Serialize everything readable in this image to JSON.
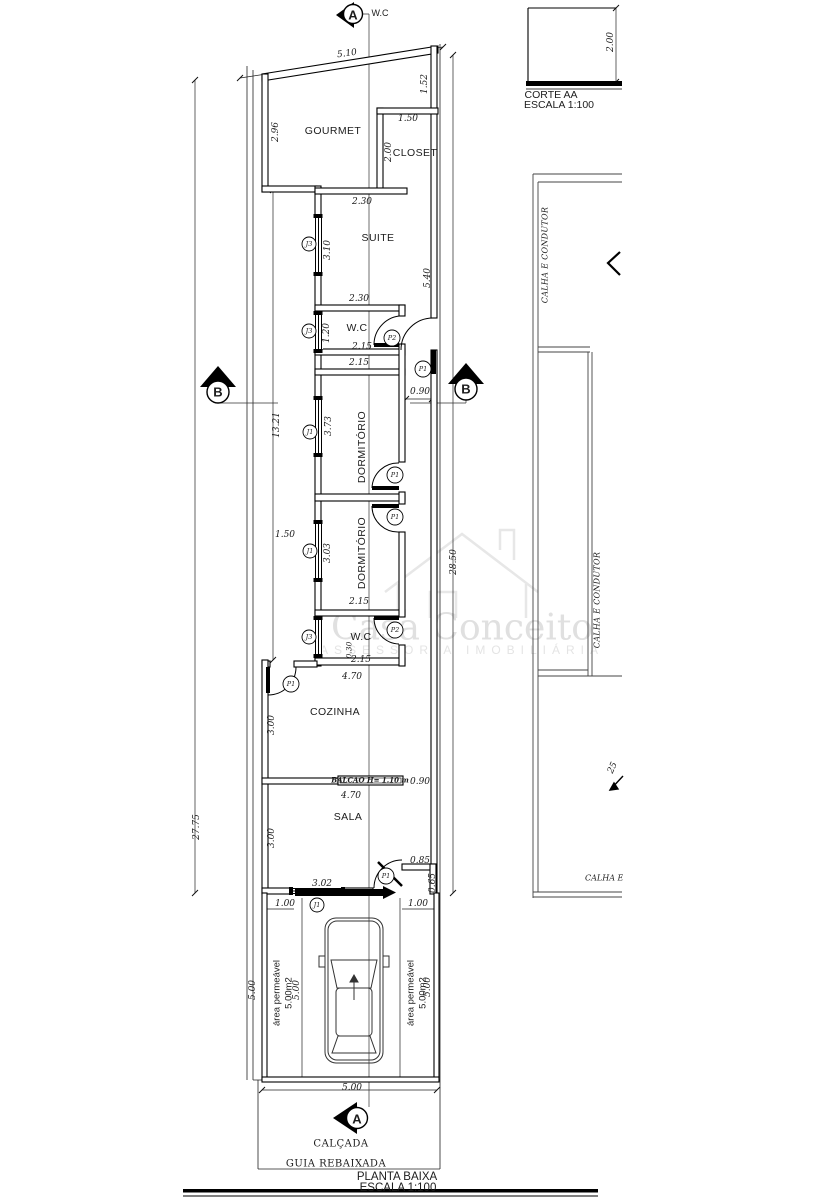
{
  "drawing": {
    "type": "architectural floor plan",
    "line_color": "#000000",
    "background": "#ffffff",
    "watermark_color": "#e0e0e0"
  },
  "watermark": {
    "brand": "Casa Conceito",
    "subtitle": "ASSESSORIA IMOBILIÁRIA"
  },
  "labels": [
    {
      "n": "room-label-gourmet",
      "t": "GOURMET",
      "x": 333,
      "y": 131,
      "c": "room"
    },
    {
      "n": "room-label-closet",
      "t": "CLOSET",
      "x": 415,
      "y": 153,
      "c": "room"
    },
    {
      "n": "room-label-suite",
      "t": "SUITE",
      "x": 378,
      "y": 238,
      "c": "room"
    },
    {
      "n": "room-label-wc-suite",
      "t": "W.C",
      "x": 357,
      "y": 328,
      "c": "room"
    },
    {
      "n": "room-label-dormitorio-1",
      "t": "DORMITÓRIO",
      "x": 362,
      "y": 447,
      "r": -90,
      "c": "room"
    },
    {
      "n": "room-label-dormitorio-2",
      "t": "DORMITÓRIO",
      "x": 362,
      "y": 553,
      "r": -90,
      "c": "room"
    },
    {
      "n": "room-label-wc-2",
      "t": "W.C",
      "x": 361,
      "y": 637,
      "c": "room"
    },
    {
      "n": "room-label-cozinha",
      "t": "COZINHA",
      "x": 335,
      "y": 712,
      "c": "room"
    },
    {
      "n": "room-label-sala",
      "t": "SALA",
      "x": 348,
      "y": 817,
      "c": "room"
    },
    {
      "n": "section-a-top-text",
      "t": "W.C",
      "x": 380,
      "y": 13,
      "c": "room9"
    },
    {
      "n": "area-permeavel-left-line1",
      "t": "área permeável",
      "x": 277,
      "y": 993,
      "r": -90,
      "c": "room10"
    },
    {
      "n": "area-permeavel-left-line2",
      "t": "5.00m2",
      "x": 289,
      "y": 993,
      "r": -90,
      "c": "room10"
    },
    {
      "n": "area-permeavel-right-line1",
      "t": "área permeável",
      "x": 411,
      "y": 993,
      "r": -90,
      "c": "room10"
    },
    {
      "n": "area-permeavel-right-line2",
      "t": "5.00m2",
      "x": 423,
      "y": 993,
      "r": -90,
      "c": "room10"
    },
    {
      "n": "dim-top-width",
      "t": "5.10",
      "x": 347,
      "y": 54,
      "r": -8,
      "c": "dim"
    },
    {
      "n": "dim-gourmet-left",
      "t": "2.96",
      "x": 276,
      "y": 132,
      "r": -90,
      "c": "dim"
    },
    {
      "n": "dim-right-top",
      "t": "1.52",
      "x": 425,
      "y": 84,
      "r": -90,
      "c": "dim"
    },
    {
      "n": "dim-closet-width",
      "t": "1.50",
      "x": 408,
      "y": 119,
      "c": "dim"
    },
    {
      "n": "dim-closet-depth",
      "t": "2.00",
      "x": 389,
      "y": 152,
      "r": -90,
      "c": "dim"
    },
    {
      "n": "dim-suite-top",
      "t": "2.30",
      "x": 362,
      "y": 202,
      "c": "dim"
    },
    {
      "n": "dim-suite-left",
      "t": "3.10",
      "x": 328,
      "y": 250,
      "r": -90,
      "c": "dim"
    },
    {
      "n": "dim-suite-right",
      "t": "5.40",
      "x": 428,
      "y": 278,
      "r": -90,
      "c": "dim"
    },
    {
      "n": "dim-suite-bottom",
      "t": "2.30",
      "x": 359,
      "y": 299,
      "c": "dim"
    },
    {
      "n": "dim-wc1-left",
      "t": "1.20",
      "x": 327,
      "y": 333,
      "r": -90,
      "c": "dim"
    },
    {
      "n": "dim-wc1-width",
      "t": "2.15",
      "x": 362,
      "y": 347,
      "c": "dim"
    },
    {
      "n": "dim-dorm1-top",
      "t": "2.15",
      "x": 359,
      "y": 363,
      "c": "dim"
    },
    {
      "n": "dim-hall-width",
      "t": "0.90",
      "x": 420,
      "y": 392,
      "c": "dim"
    },
    {
      "n": "dim-dorm1-left",
      "t": "3.73",
      "x": 329,
      "y": 426,
      "r": -90,
      "c": "dim"
    },
    {
      "n": "dim-passage-length",
      "t": "13.21",
      "x": 277,
      "y": 425,
      "r": -90,
      "c": "dim"
    },
    {
      "n": "dim-lot-depth-left",
      "t": "27.75",
      "x": 197,
      "y": 827,
      "r": -90,
      "c": "dim"
    },
    {
      "n": "dim-house-depth-right",
      "t": "28.50",
      "x": 454,
      "y": 562,
      "r": -90,
      "c": "dim"
    },
    {
      "n": "dim-dorm2-offset",
      "t": "1.50",
      "x": 285,
      "y": 535,
      "c": "dim"
    },
    {
      "n": "dim-dorm2-left",
      "t": "3.03",
      "x": 328,
      "y": 553,
      "r": -90,
      "c": "dim"
    },
    {
      "n": "dim-dorm2-bottom",
      "t": "2.15",
      "x": 359,
      "y": 602,
      "c": "dim"
    },
    {
      "n": "dim-wc2-small",
      "t": "0.30",
      "x": 349,
      "y": 650,
      "r": -90,
      "c": "dim8"
    },
    {
      "n": "dim-wc2-width",
      "t": "2.15",
      "x": 361,
      "y": 660,
      "c": "dim"
    },
    {
      "n": "dim-cozinha-top",
      "t": "4.70",
      "x": 352,
      "y": 677,
      "c": "dim"
    },
    {
      "n": "dim-cozinha-left",
      "t": "3.00",
      "x": 272,
      "y": 725,
      "r": -90,
      "c": "dim"
    },
    {
      "n": "dim-balcao-pass",
      "t": "0.90",
      "x": 420,
      "y": 782,
      "c": "dim"
    },
    {
      "n": "dim-sala-top",
      "t": "4.70",
      "x": 351,
      "y": 796,
      "c": "dim"
    },
    {
      "n": "dim-sala-left",
      "t": "3.00",
      "x": 272,
      "y": 838,
      "r": -90,
      "c": "dim"
    },
    {
      "n": "dim-front-door",
      "t": "0.85",
      "x": 420,
      "y": 861,
      "c": "dim"
    },
    {
      "n": "dim-front-jog",
      "t": "0.65",
      "x": 433,
      "y": 883,
      "r": -90,
      "c": "dim"
    },
    {
      "n": "dim-sala-front",
      "t": "3.02",
      "x": 322,
      "y": 884,
      "c": "dim"
    },
    {
      "n": "dim-front-left",
      "t": "1.00",
      "x": 285,
      "y": 904,
      "c": "dim"
    },
    {
      "n": "dim-front-right",
      "t": "1.00",
      "x": 418,
      "y": 904,
      "c": "dim"
    },
    {
      "n": "dim-garage-depth-1",
      "t": "5.00",
      "x": 253,
      "y": 990,
      "r": -90,
      "c": "dim"
    },
    {
      "n": "dim-garage-depth-2",
      "t": "5.00",
      "x": 297,
      "y": 990,
      "r": -90,
      "c": "dim"
    },
    {
      "n": "dim-garage-depth-3",
      "t": "5.00",
      "x": 428,
      "y": 987,
      "r": -90,
      "c": "dim"
    },
    {
      "n": "dim-garage-width",
      "t": "5.00",
      "x": 352,
      "y": 1088,
      "c": "dim"
    },
    {
      "n": "dim-corte-height",
      "t": "2.00",
      "x": 611,
      "y": 42,
      "r": -90,
      "c": "dim"
    },
    {
      "n": "window-tag-j3-suite",
      "t": "J3",
      "x": 309,
      "y": 244,
      "c": "tag"
    },
    {
      "n": "window-tag-j3-wc1",
      "t": "J3",
      "x": 309,
      "y": 331,
      "c": "tag"
    },
    {
      "n": "window-tag-j1-dorm1",
      "t": "J1",
      "x": 310,
      "y": 432,
      "c": "tag"
    },
    {
      "n": "window-tag-j1-dorm2",
      "t": "J1",
      "x": 310,
      "y": 551,
      "c": "tag"
    },
    {
      "n": "window-tag-j3-wc2",
      "t": "J3",
      "x": 309,
      "y": 637,
      "c": "tag"
    },
    {
      "n": "window-tag-j1-front",
      "t": "J1",
      "x": 317,
      "y": 905,
      "c": "tag"
    },
    {
      "n": "door-tag-p2-wc1",
      "t": "P2",
      "x": 392,
      "y": 338,
      "c": "tag"
    },
    {
      "n": "door-tag-p1-hall",
      "t": "P1",
      "x": 423,
      "y": 369,
      "c": "tag"
    },
    {
      "n": "door-tag-p1-dorm1",
      "t": "P1",
      "x": 395,
      "y": 475,
      "c": "tag"
    },
    {
      "n": "door-tag-p1-dorm2",
      "t": "P1",
      "x": 395,
      "y": 517,
      "c": "tag"
    },
    {
      "n": "door-tag-p2-wc2",
      "t": "P2",
      "x": 395,
      "y": 630,
      "c": "tag"
    },
    {
      "n": "door-tag-p1-cozinha",
      "t": "P1",
      "x": 291,
      "y": 684,
      "c": "tag"
    },
    {
      "n": "door-tag-p1-sala",
      "t": "P1",
      "x": 386,
      "y": 876,
      "c": "tag"
    },
    {
      "n": "marker-a-top-letter",
      "t": "A",
      "x": 353,
      "y": 15,
      "c": "marker"
    },
    {
      "n": "marker-a-bottom-letter",
      "t": "A",
      "x": 357,
      "y": 1119,
      "c": "marker"
    },
    {
      "n": "marker-b-left-letter",
      "t": "B",
      "x": 218,
      "y": 392,
      "c": "marker"
    },
    {
      "n": "marker-b-right-letter",
      "t": "B",
      "x": 466,
      "y": 389,
      "c": "marker"
    },
    {
      "n": "corte-title",
      "t": "CORTE AA",
      "x": 551,
      "y": 95,
      "c": "title11"
    },
    {
      "n": "corte-scale",
      "t": "ESCALA 1:100",
      "x": 559,
      "y": 105,
      "c": "title11"
    },
    {
      "n": "plan-title",
      "t": "PLANTA BAIXA",
      "x": 397,
      "y": 1177,
      "c": "title12"
    },
    {
      "n": "plan-scale",
      "t": "ESCALA 1:100",
      "x": 398,
      "y": 1188,
      "c": "title12"
    },
    {
      "n": "calcada-label",
      "t": "CALÇADA",
      "x": 341,
      "y": 1144,
      "c": "cap"
    },
    {
      "n": "guia-rebaixada-label",
      "t": "GUIA REBAIXADA",
      "x": 336,
      "y": 1164,
      "c": "cap"
    },
    {
      "n": "balcao-label",
      "t": "BALCÃO H= 1.10 m",
      "x": 370,
      "y": 780,
      "c": "balcao"
    },
    {
      "n": "roof-calha-top",
      "t": "CALHA E CONDUTOR",
      "x": 545,
      "y": 255,
      "r": -90,
      "c": "roof"
    },
    {
      "n": "roof-calha-mid",
      "t": "CALHA E CONDUTOR",
      "x": 597,
      "y": 600,
      "r": -90,
      "c": "roof"
    },
    {
      "n": "roof-slope-value",
      "t": "25",
      "x": 613,
      "y": 768,
      "r": -65,
      "c": "dim"
    },
    {
      "n": "roof-calha-bottom",
      "t": "CALHA E CONDUTOR",
      "x": 585,
      "y": 878,
      "c": "roofclip"
    }
  ]
}
